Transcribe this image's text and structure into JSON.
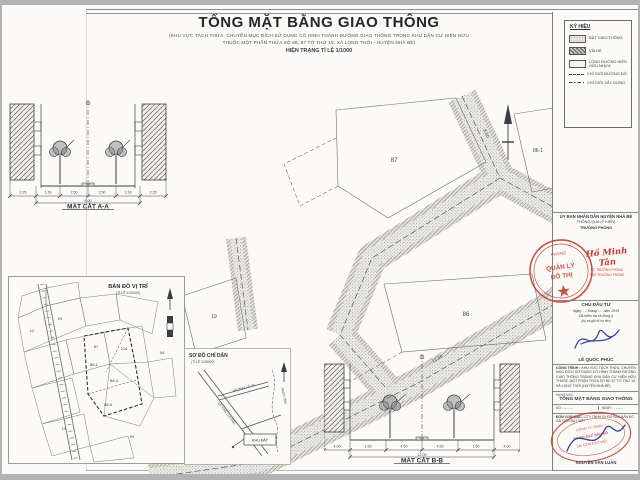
{
  "colors": {
    "stamp_red": "#c23a2e",
    "sign_blue": "#2b3f9e",
    "paper": "#fbfaf7",
    "ink": "#33333a"
  },
  "header": {
    "title": "TỔNG MẶT BẰNG GIAO THÔNG",
    "subtitle1": "(KHU VỰC TÁCH THỬA, CHUYỂN MỤC ĐÍCH SỬ DỤNG CÓ HÌNH THÀNH ĐƯỜNG GIAO THÔNG TRONG KHU DÂN CƯ HIỆN HỮU",
    "subtitle2": "THUỘC MỘT PHẦN THỬA SỐ 86, 87 TỜ THỨ 19, XÃ LONG THỚI - HUYỆN NHÀ BÈ)",
    "scale_line": "HIỆN TRẠNG TỈ LỆ 1/1000"
  },
  "legend": {
    "title": "KÝ HIỆU",
    "items": [
      {
        "label": "ĐẤT GIAO THÔNG"
      },
      {
        "label": "VỈA HÈ"
      },
      {
        "label": "LÒNG ĐƯỜNG HIỆN HỮU NHỰA"
      },
      {
        "label": "CHỈ GIỚI ĐƯỜNG ĐỎ"
      },
      {
        "label": "CHỈ GIỚI XÂY DỰNG"
      }
    ]
  },
  "sections": {
    "aa": {
      "label": "MẶT CẮT A-A",
      "dims": [
        "2.25",
        "1.50",
        "2.50",
        "2.50",
        "1.50",
        "2.25"
      ],
      "total": "8.00"
    },
    "bb": {
      "label": "MẶT CẮT B-B",
      "dims": [
        "4.00",
        "1.50",
        "4.50",
        "4.50",
        "1.50",
        "4.00"
      ],
      "total": "12.00"
    }
  },
  "plan": {
    "lot_87": "87",
    "lot_86": "86",
    "lot_86_1": "86-1",
    "lot_19": "19",
    "dim_road_a": "8.00",
    "dim_road_b": "12.00"
  },
  "location_map": {
    "title": "BẢN ĐỒ VỊ TRÍ",
    "scale": "(TỈ LỆ 1/10000)",
    "labels": [
      "12",
      "29",
      "87",
      "214",
      "54",
      "86-4",
      "86-6",
      "19",
      "94",
      "86-1"
    ]
  },
  "guide_map": {
    "title": "SƠ ĐỒ CHỈ DẪN",
    "scale": "(TỈ LỆ 1/25000)",
    "road1": "LÊ VĂN LƯƠNG",
    "road2": "HƯƠNG LỘ 34",
    "site_box": "KHU ĐẤT",
    "stream": "RẠCH TÔM"
  },
  "title_block": {
    "agency": "ỦY BAN NHÂN DÂN HUYỆN NHÀ BÈ",
    "approval": "THÔNG QUA (Ý KIẾN)",
    "approver_role": "TRƯỞNG PHÒNG",
    "stamp1": {
      "l1": "PHÒNG",
      "l2": "QUẢN LÝ",
      "l3": "ĐÔ THỊ"
    },
    "signer1": "Hồ Minh Tân",
    "signer1_note1": "KT. TRƯỞNG PHÒNG",
    "signer1_note2": "PHÓ TRƯỞNG PHÒNG",
    "investor_title": "CHỦ ĐẦU TƯ",
    "investor_date": "Ngày ..... tháng ..... năm 2019",
    "investor_note1": "Đã kiểm tra và đồng ý",
    "investor_note2": "(ký và ghi rõ họ tên)",
    "signer2": "LÊ QUỐC PHÚC",
    "project_label": "CÔNG TRÌNH :",
    "project_text": "KHU VỰC TÁCH THỬA, CHUYỂN MỤC ĐÍCH SỬ DỤNG CÓ HÌNH THÀNH ĐƯỜNG GIAO THÔNG TRONG KHU DÂN CƯ HIỆN HỮU THUỘC MỘT PHẦN THỬA SỐ 86, 87 TỜ THỨ 19, XÃ LONG THỚI (HUYỆN NHÀ BÈ)",
    "item_label": "HẠNG MỤC :",
    "item_text": "TỔNG MẶT BẰNG GIAO THÔNG",
    "no_label": "SỐ :",
    "no_value": "..........",
    "date_label": "NGÀY :",
    "date_value": "..........",
    "surveyor_label": "ĐƠN VỊ ĐO ĐẠC :",
    "surveyor_text": "CTY TNHH DV ĐO ĐẠC BẢN ĐỒ SÀI GÒN ĐẤT VIỆT",
    "stamp2": {
      "l1": "CÔNG TY TNHH",
      "l2": "DV ĐO ĐẠC BẢN ĐỒ",
      "l3": "SÀI GÒN ĐẤT VIỆT"
    },
    "signer3": "NGUYỄN VĂN LUÂN"
  }
}
